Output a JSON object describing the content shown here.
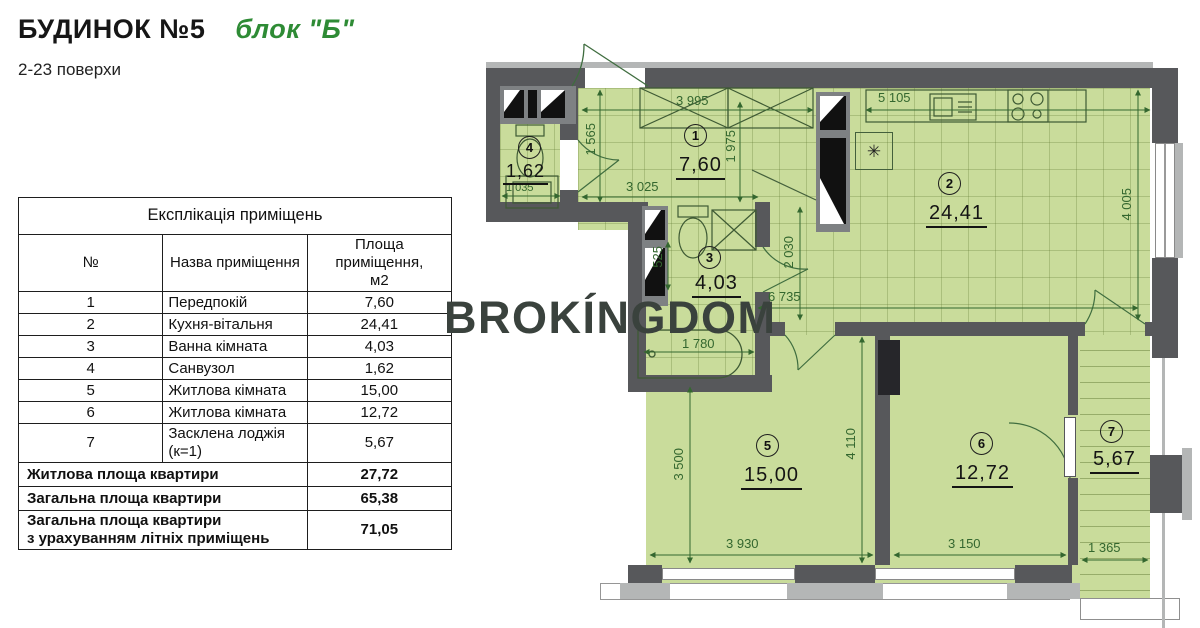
{
  "header": {
    "title": "БУДИНОК №5",
    "block": "блок \"Б\"",
    "floors": "2-23 поверхи"
  },
  "watermark": "BROKÍNGDOM",
  "table": {
    "caption": "Експлікація приміщень",
    "col_num": "№",
    "col_name": "Назва приміщення",
    "col_area": "Площа\nприміщення,\nм2",
    "rows": [
      {
        "num": "1",
        "name": "Передпокій",
        "area": "7,60"
      },
      {
        "num": "2",
        "name": "Кухня-вітальня",
        "area": "24,41"
      },
      {
        "num": "3",
        "name": "Ванна кімната",
        "area": "4,03"
      },
      {
        "num": "4",
        "name": "Санвузол",
        "area": "1,62"
      },
      {
        "num": "5",
        "name": "Житлова кімната",
        "area": "15,00"
      },
      {
        "num": "6",
        "name": "Житлова кімната",
        "area": "12,72"
      },
      {
        "num": "7",
        "name": "Засклена лоджія  (к=1)",
        "area": "5,67"
      }
    ],
    "totals": [
      {
        "name": "Житлова площа квартири",
        "area": "27,72"
      },
      {
        "name": "Загальна площа квартири",
        "area": "65,38"
      },
      {
        "name": "Загальна площа квартири\nз урахуванням літніх приміщень",
        "area": "71,05"
      }
    ]
  },
  "plan": {
    "rooms": [
      {
        "num": "1",
        "area": "7,60"
      },
      {
        "num": "2",
        "area": "24,41"
      },
      {
        "num": "3",
        "area": "4,03"
      },
      {
        "num": "4",
        "area": "1,62"
      },
      {
        "num": "5",
        "area": "15,00"
      },
      {
        "num": "6",
        "area": "12,72"
      },
      {
        "num": "7",
        "area": "5,67"
      }
    ],
    "dims": {
      "d3995": "3 995",
      "d1565": "1 565",
      "d1975": "1 975",
      "d3025": "3 025",
      "d1035": "1 035",
      "d5105": "5 105",
      "d4005": "4 005",
      "d2030": "2 030",
      "d6735": "6 735",
      "d525": "525",
      "d1780": "1 780",
      "d3500": "3 500",
      "d4110": "4 110",
      "d3930": "3 930",
      "d3150": "3 150",
      "d1365": "1 365"
    },
    "symbols": {
      "asterisk": "✳"
    }
  },
  "colors": {
    "room_fill": "#c9dc9b",
    "wall": "#57585b",
    "dim_green": "#34672f",
    "accent_green": "#2e8b35",
    "watermark": "#3a423d"
  }
}
